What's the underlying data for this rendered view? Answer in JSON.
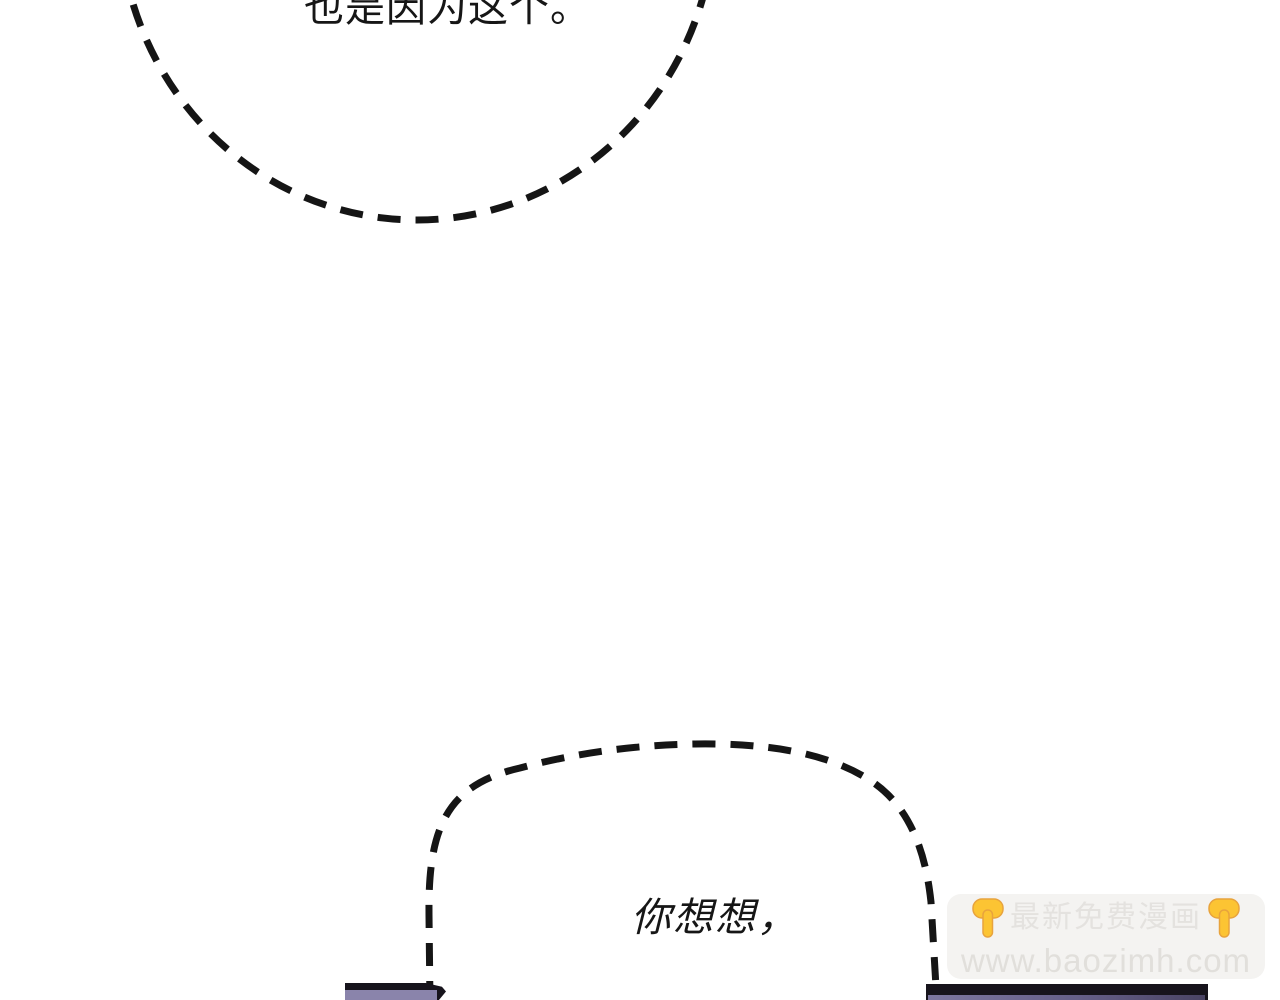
{
  "comic": {
    "background_color": "#ffffff",
    "line_color": "#151515",
    "top_bubble": {
      "text": "也是因为这个。"
    },
    "bottom_bubble": {
      "text": "你想想，"
    }
  },
  "scene": {
    "object_outline_color": "#17141c",
    "left_object_fill": "#8a84ab",
    "right_object_fill_start": "#7d77a0",
    "right_object_fill_end": "#4a4464"
  },
  "watermark": {
    "line1": "最新免费漫画",
    "line2": "www.baozimh.com",
    "background_color": "#f4f3f1",
    "text_color": "#e4e2df",
    "hand_icon_color": "#fcc433"
  }
}
